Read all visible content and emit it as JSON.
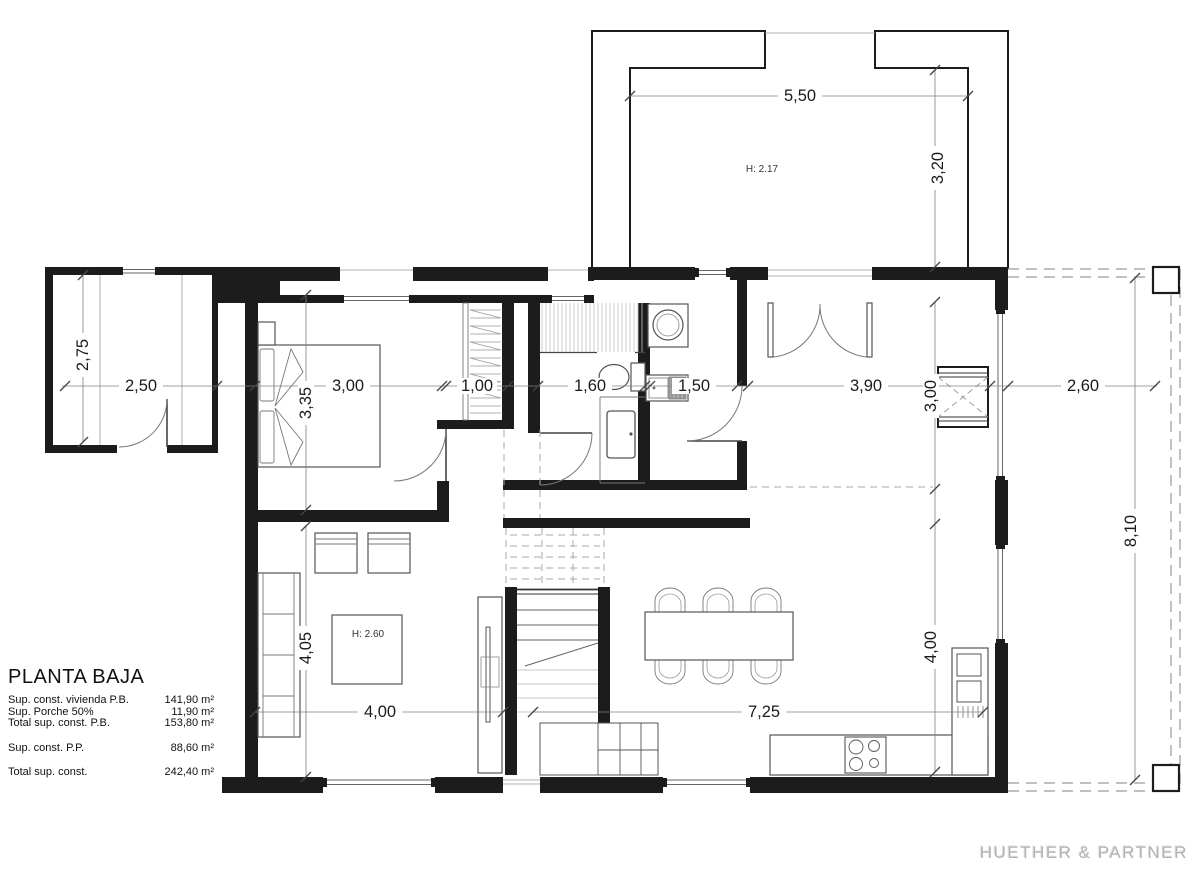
{
  "plan": {
    "title_block": {
      "title": "PLANTA BAJA",
      "rows": [
        {
          "label": "Sup. const. vivienda P.B.",
          "value": "141,90 m²"
        },
        {
          "label": "Sup. Porche 50%",
          "value": "11,90 m²"
        },
        {
          "label": "Total sup. const. P.B.",
          "value": "153,80 m²"
        },
        {
          "label": "Sup. const. P.P.",
          "value": "88,60 m²"
        },
        {
          "label": "Total sup. const.",
          "value": "242,40 m²"
        }
      ]
    },
    "firm": "HUETHER & PARTNER",
    "heights": {
      "garage": "H: 2.17",
      "living": "H: 2.60"
    },
    "dims": {
      "garage_width": "5,50",
      "garage_depth": "3,20",
      "entry_porch_depth": "2,75",
      "entry_porch_width": "2,50",
      "bedroom_width": "3,00",
      "bedroom_depth": "3,35",
      "wardrobe_width": "1,00",
      "bathroom_width": "1,60",
      "utility_width": "1,50",
      "hall_width": "3,90",
      "hall_depth": "3,00",
      "terrace_width": "2,60",
      "terrace_depth": "8,10",
      "living_width": "4,00",
      "living_depth": "4,05",
      "dining_width": "7,25",
      "kitchen_depth": "4,00"
    }
  }
}
